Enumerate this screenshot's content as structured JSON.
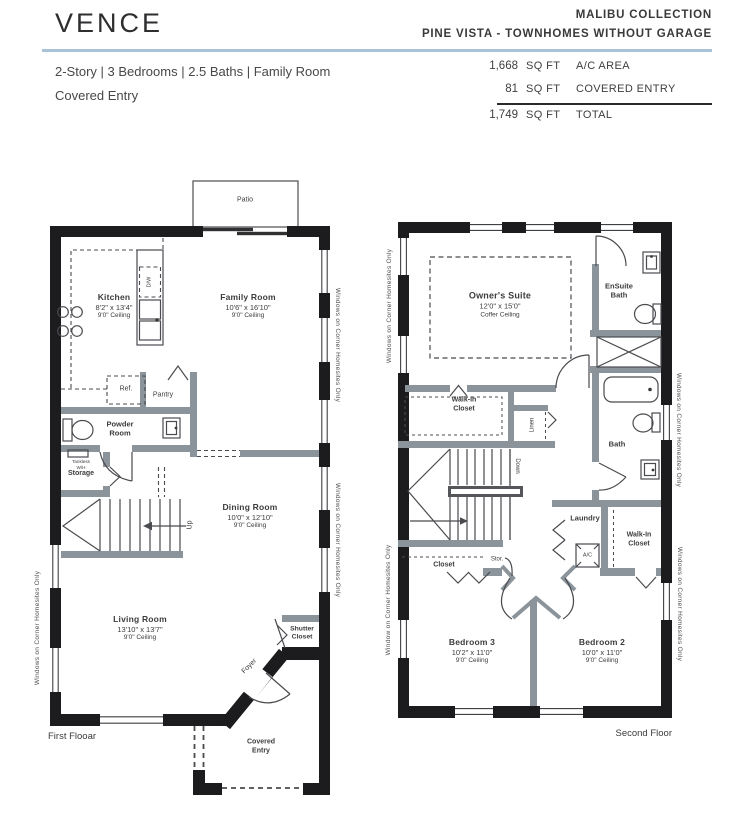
{
  "header": {
    "title": "VENCE",
    "collection": "MALIBU COLLECTION",
    "community": "PINE VISTA - TOWNHOMES WITHOUT GARAGE",
    "specs_line1": "2-Story | 3 Bedrooms | 2.5 Baths | Family Room",
    "specs_line2": "Covered Entry",
    "area_table": {
      "rows": [
        {
          "value": "1,668",
          "unit": "SQ FT",
          "label": "A/C AREA"
        },
        {
          "value": "81",
          "unit": "SQ FT",
          "label": "COVERED ENTRY"
        },
        {
          "value": "1,749",
          "unit": "SQ FT",
          "label": "TOTAL"
        }
      ]
    }
  },
  "first_floor": {
    "floor_label": "First Flooar",
    "patio": "Patio",
    "rooms": {
      "kitchen": {
        "name": "Kitchen",
        "dims": "8'2\" x 13'4\"",
        "ceiling": "9'0\" Ceiling"
      },
      "family_room": {
        "name": "Family Room",
        "dims": "10'6\" x 16'10\"",
        "ceiling": "9'0\" Ceiling"
      },
      "dining_room": {
        "name": "Dining Room",
        "dims": "10'0\" x 12'10\"",
        "ceiling": "9'0\" Ceiling"
      },
      "living_room": {
        "name": "Living Room",
        "dims": "13'10\" x 13'7\"",
        "ceiling": "9'0\" Ceiling"
      },
      "powder_room": {
        "line1": "Powder",
        "line2": "Room"
      },
      "shutter_closet": {
        "line1": "Shutter",
        "line2": "Closet"
      },
      "storage": {
        "line1": "Tankless",
        "line2": "W/H",
        "line3": "Storage"
      },
      "covered_entry": {
        "line1": "Covered",
        "line2": "Entry"
      },
      "foyer": "Foyer"
    },
    "fixtures": {
      "dw": "D/W",
      "ref": "Ref.",
      "pantry": "Pantry",
      "up": "Up"
    },
    "notes": {
      "left": "Windows on Corner Homesites Only",
      "right1": "Windows on Corner Homesites Only",
      "right2": "Windows on Corner Homesites Only"
    }
  },
  "second_floor": {
    "floor_label": "Second Floor",
    "rooms": {
      "owners_suite": {
        "name": "Owner's Suite",
        "dims": "12'0\" x 15'0\"",
        "ceiling": "Coffer Ceiling"
      },
      "bedroom3": {
        "name": "Bedroom 3",
        "dims": "10'2\" x 11'0\"",
        "ceiling": "9'0\" Ceiling"
      },
      "bedroom2": {
        "name": "Bedroom 2",
        "dims": "10'0\" x 11'0\"",
        "ceiling": "9'0\" Ceiling"
      },
      "ensuite": {
        "line1": "EnSuite",
        "line2": "Bath"
      },
      "bath": "Bath",
      "laundry": "Laundry",
      "walkin1": {
        "line1": "Walk-In",
        "line2": "Closet"
      },
      "walkin2": {
        "line1": "Walk-In",
        "line2": "Closet"
      },
      "closet": "Closet",
      "linen": "Linen"
    },
    "fixtures": {
      "ac": "A/C",
      "down": "Down",
      "stor": "Stor."
    },
    "notes": {
      "left1": "Windows on Corner Homesites Only",
      "left2": "Window on Corner Homesites Only",
      "right1": "Windows on Corner Homesites Only",
      "right2": "Windows on Corner Homesites Only"
    }
  },
  "colors": {
    "exterior_wall": "#1c1c1e",
    "interior_wall": "#8a949a",
    "accent_line": "#a9c3d6",
    "linework": "#4a4b4f"
  }
}
